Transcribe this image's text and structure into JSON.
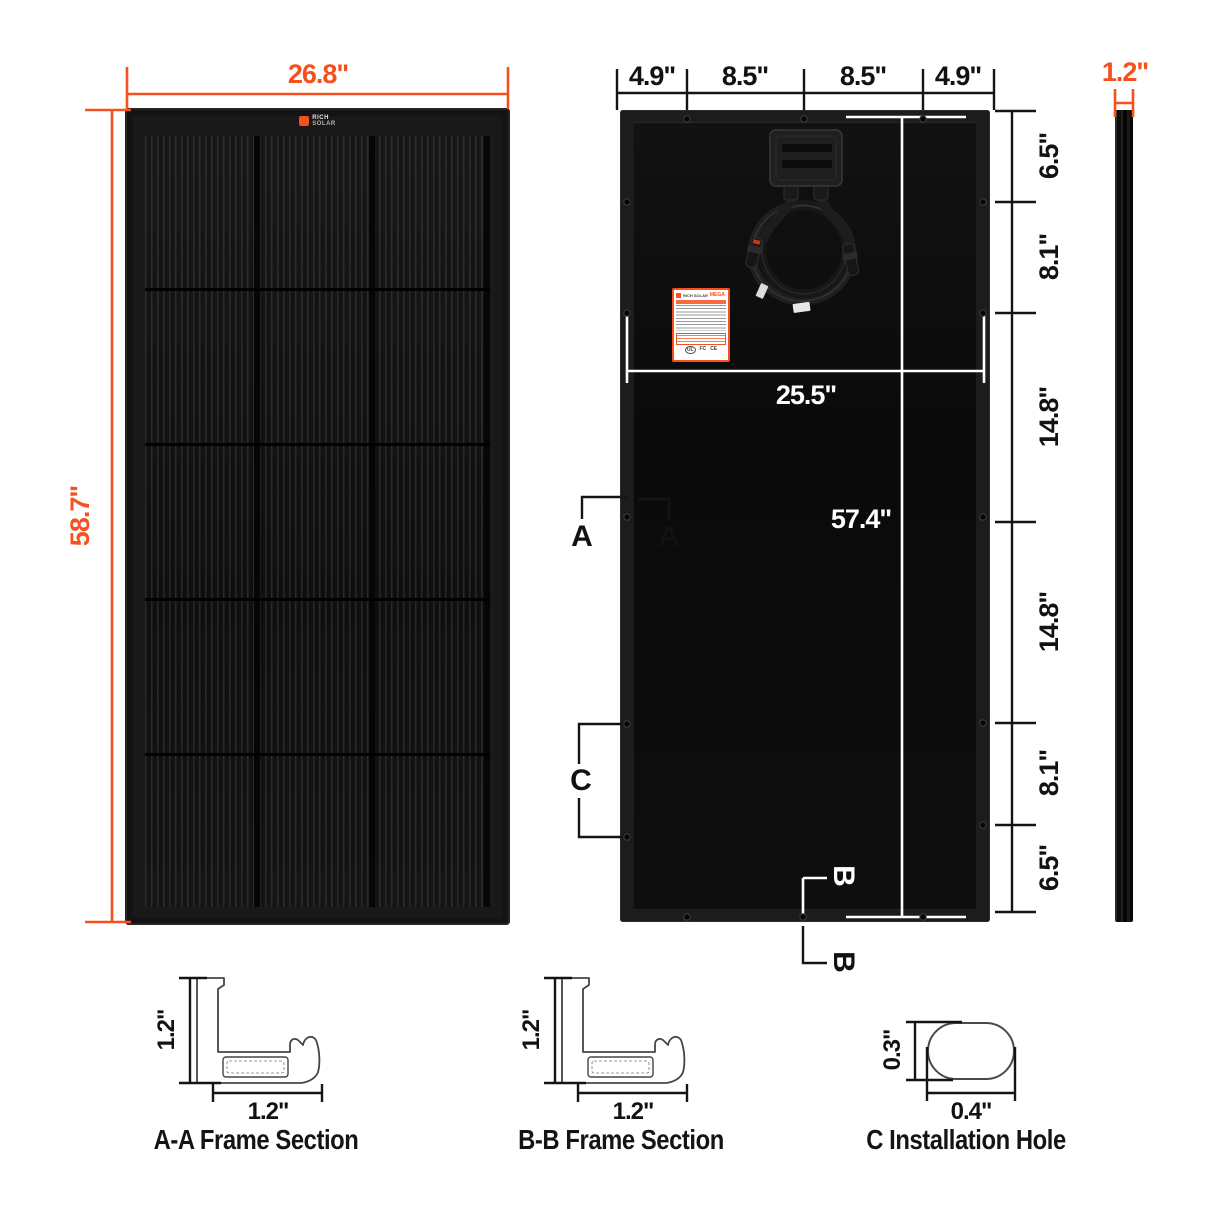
{
  "front_view": {
    "logo": {
      "brand_top": "RICH",
      "brand_bottom": "SOLAR"
    },
    "dim_width": "26.8\"",
    "dim_height": "58.7\""
  },
  "back_view": {
    "dims_top": [
      {
        "label": "4.9\""
      },
      {
        "label": "8.5\""
      },
      {
        "label": "8.5\""
      },
      {
        "label": "4.9\""
      }
    ],
    "dims_right": [
      {
        "label": "6.5\""
      },
      {
        "label": "8.1\""
      },
      {
        "label": "14.8\""
      },
      {
        "label": "14.8\""
      },
      {
        "label": "8.1\""
      },
      {
        "label": "6.5\""
      }
    ],
    "dim_hole_span": "25.5\"",
    "dim_height_inner": "57.4\"",
    "marker_a_left": "A",
    "marker_a_right": "A",
    "marker_c": "C",
    "marker_b_top": "B",
    "marker_b_bottom": "B",
    "label_sticker": {
      "brand": "RICH SOLAR",
      "series": "MEGA",
      "certifications": [
        "UL",
        "FC",
        "CE"
      ]
    }
  },
  "side_view": {
    "dim_thickness": "1.2\""
  },
  "sections": {
    "aa": {
      "dim_vertical": "1.2\"",
      "dim_horizontal": "1.2\"",
      "caption": "A-A Frame Section"
    },
    "bb": {
      "dim_vertical": "1.2\"",
      "dim_horizontal": "1.2\"",
      "caption": "B-B Frame Section"
    },
    "c": {
      "dim_vertical": "0.3\"",
      "dim_horizontal": "0.4\"",
      "caption": "C Installation Hole"
    }
  },
  "colors": {
    "accent": "#F4511E",
    "dim_black": "#141414",
    "dim_white": "#FFFFFF",
    "panel_black": "#0C0C0C"
  }
}
